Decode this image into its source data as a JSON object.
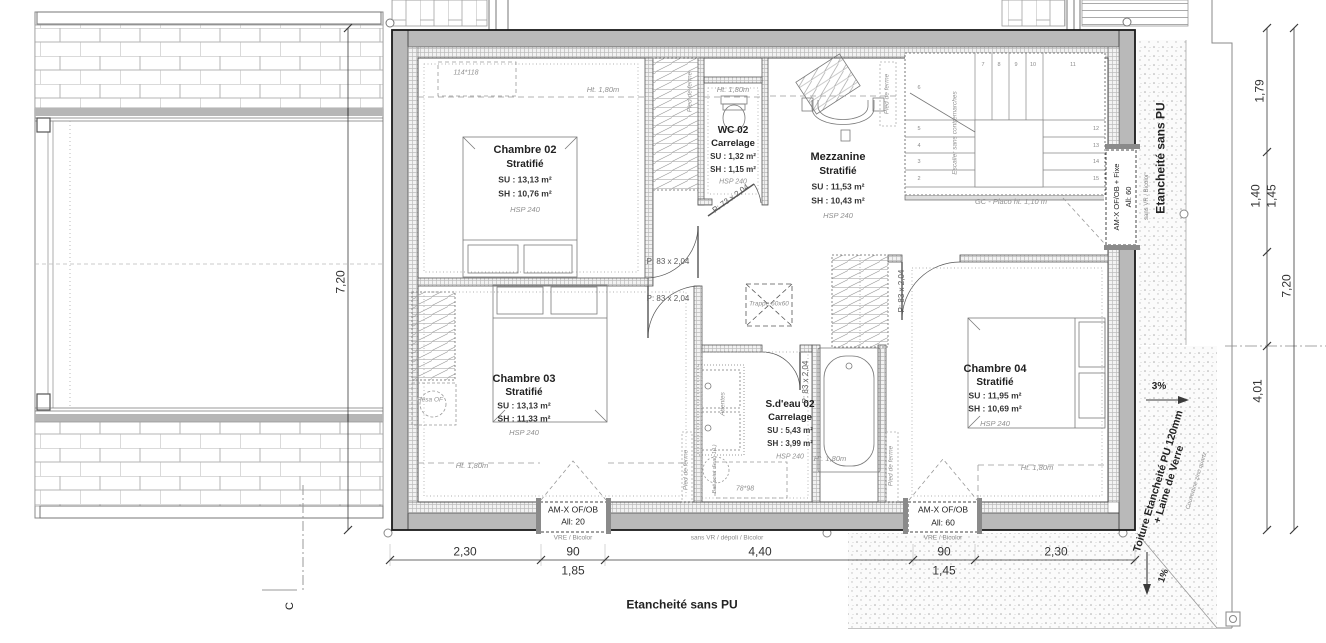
{
  "colors": {
    "wall_gray": "#b9b9b9",
    "line_dark": "#1a1a1a",
    "muted": "#8c8c8c"
  },
  "rooms": {
    "ch02": {
      "name": "Chambre 02",
      "finish": "Stratifié",
      "su": "SU : 13,13 m²",
      "sh": "SH : 10,76 m²",
      "hsp": "HSP 240"
    },
    "wc02": {
      "name": "WC 02",
      "finish": "Carrelage",
      "su": "SU : 1,32 m²",
      "sh": "SH : 1,15 m²",
      "hsp": "HSP 240"
    },
    "mezz": {
      "name": "Mezzanine",
      "finish": "Stratifié",
      "su": "SU : 11,53 m²",
      "sh": "SH : 10,43 m²",
      "hsp": "HSP 240"
    },
    "ch03": {
      "name": "Chambre 03",
      "finish": "Stratifié",
      "su": "SU : 13,13 m²",
      "sh": "SH : 11,33 m²",
      "hsp": "HSP 240"
    },
    "sdeau": {
      "name": "S.d'eau 02",
      "finish": "Carrelage",
      "su": "SU : 5,43 m²",
      "sh": "SH : 3,99 m²",
      "hsp": "HSP 240"
    },
    "ch04": {
      "name": "Chambre 04",
      "finish": "Stratifié",
      "su": "SU : 11,95 m²",
      "sh": "SH : 10,69 m²",
      "hsp": "HSP 240"
    }
  },
  "doors": {
    "p83": "P: 83 x 2,04",
    "p73": "P: 73 x 2,04"
  },
  "windows": {
    "w1": {
      "l1": "AM-X OF/OB",
      "l2": "All: 20",
      "sub": "VRE / Bicolor"
    },
    "w2": {
      "l1": "AM-X OF/OB",
      "l2": "All: 60",
      "sub": "VRE / Bicolor"
    },
    "w3": {
      "l1": "AM-X OF/OB + Fixe",
      "l2": "All: 60",
      "sub": "sans VR / Bicolor"
    },
    "mid_sub": "sans VR / dépoli / Bicolor"
  },
  "annotations": {
    "skylight1": "114*118",
    "skylight2": "78*98",
    "knee_height": "Ht. 1,80m",
    "trappe": "Trappe 60x60",
    "stairs_note": "Escalier sans contremarches",
    "gc_note": "GC - Placo ht. 1,10 m",
    "pied_de_ferme": "Pied de ferme",
    "attentes": "Attentes",
    "resa_of": "Résa OF",
    "point_eau": "Bati point d'eau 1(L)",
    "etancheite_right": "Etancheité sans PU",
    "etancheite_bottom": "Etancheité sans PU",
    "toiture_l1": "Toiture Etancheité PU 120mm",
    "toiture_l2": "+ Laine de Verre",
    "couvertine": "Couvertine zinc quartz",
    "slope_3": "3%",
    "slope_1": "1%",
    "section_mark": "C"
  },
  "dimensions": {
    "bottom": [
      "2,30",
      "90",
      "1,85",
      "4,40",
      "90",
      "1,45",
      "2,30"
    ],
    "left": "7,20",
    "right": {
      "a": "1,79",
      "b": "1,40",
      "c": "1,45",
      "d": "7,20",
      "e": "4,01"
    }
  },
  "stairs": {
    "numbers": [
      "2",
      "3",
      "4",
      "5",
      "6",
      "7",
      "8",
      "9",
      "10",
      "11",
      "12",
      "13",
      "14",
      "15"
    ]
  }
}
